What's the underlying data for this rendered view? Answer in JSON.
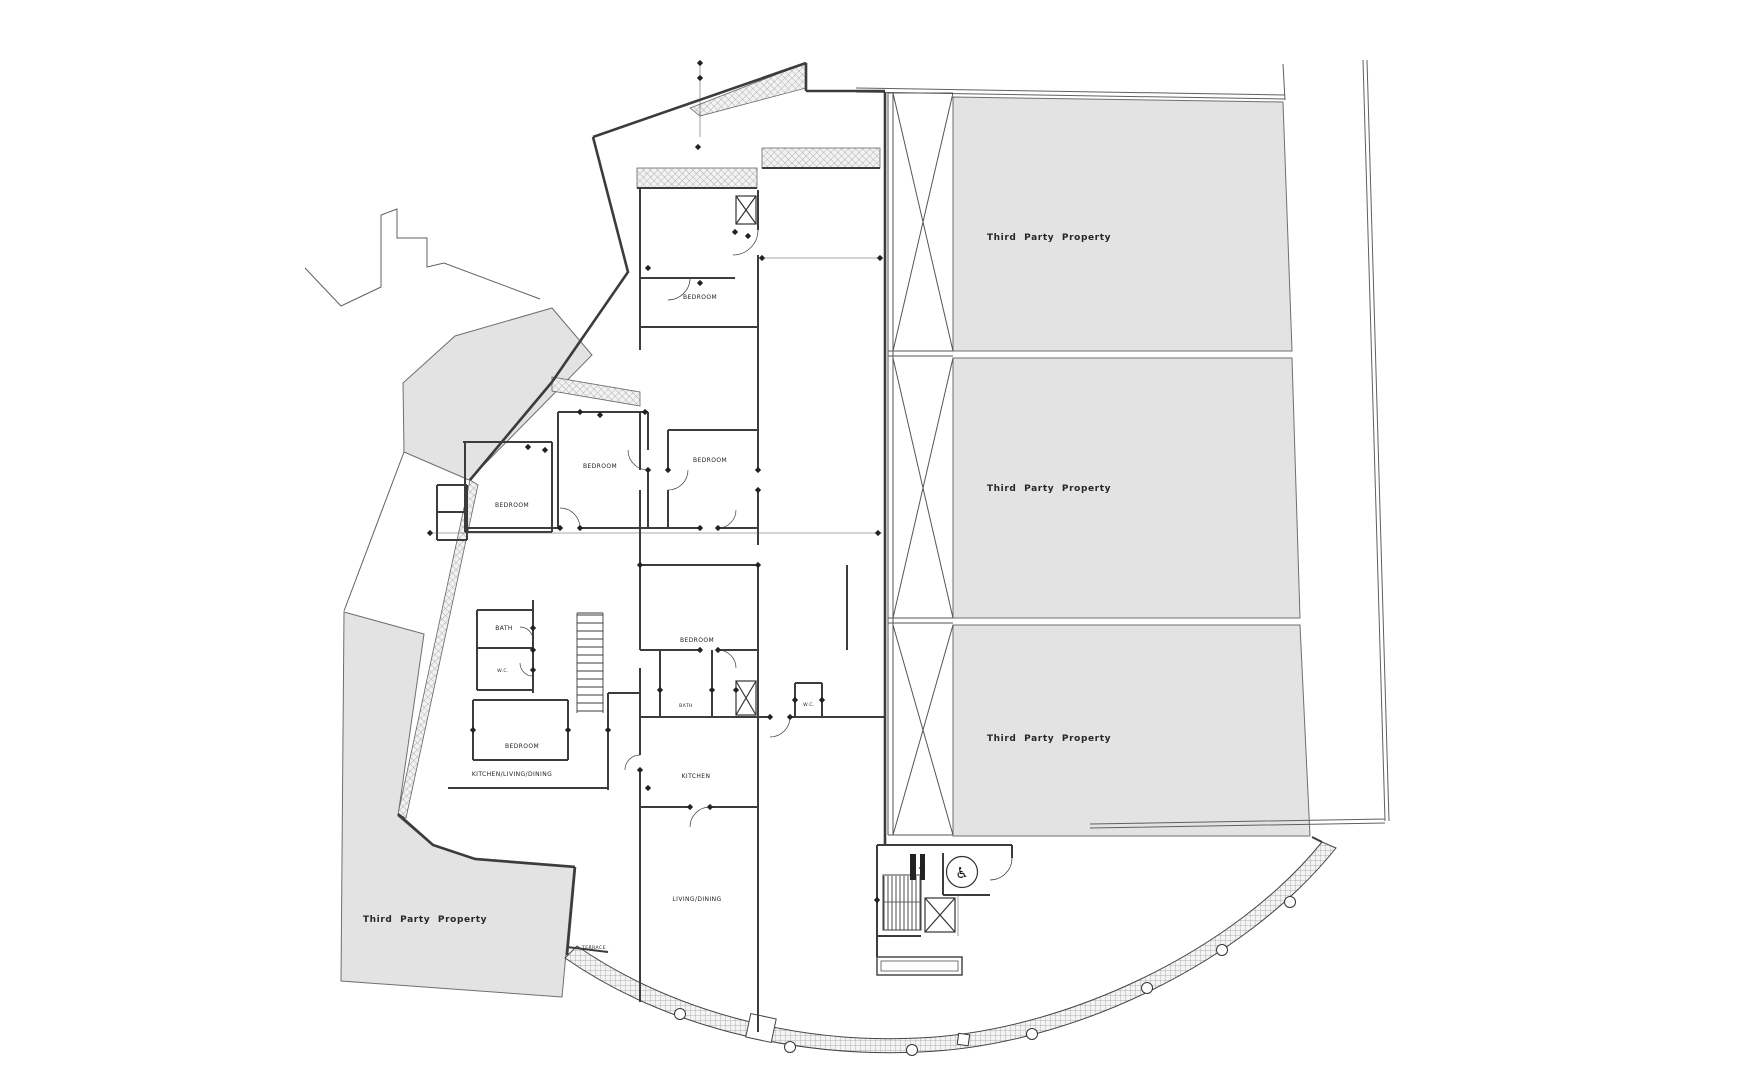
{
  "canvas": {
    "width": 1755,
    "height": 1080
  },
  "colors": {
    "paper": "#ffffff",
    "parcel_fill": "#e3e3e3",
    "parcel_stroke": "#6f6f6f",
    "ink": "#3c3c3c",
    "ink_light": "#606060",
    "hatch": "#9a9a9a",
    "label": "#1f1f1f"
  },
  "parcels": {
    "right_top_label": "Third Party Property",
    "right_middle_label": "Third Party Property",
    "right_bottom_label": "Third Party Property",
    "southwest_label": "Third Party Property"
  },
  "rooms": {
    "bedroom_1": "BEDROOM",
    "bedroom_2": "BEDROOM",
    "bedroom_3": "BEDROOM",
    "bedroom_4": "BEDROOM",
    "bedroom_5": "BEDROOM",
    "bedroom_6": "BEDROOM",
    "bath_1": "BATH",
    "wc_1": "W.C.",
    "bath_2": "BATH",
    "wc_2": "W.C.",
    "kitchen_living_dining": "KITCHEN/LIVING/DINING",
    "kitchen": "KITCHEN",
    "living_dining": "LIVING/DINING",
    "terrace": "TERRACE"
  },
  "icons": {
    "accessible_wc": "♿"
  }
}
